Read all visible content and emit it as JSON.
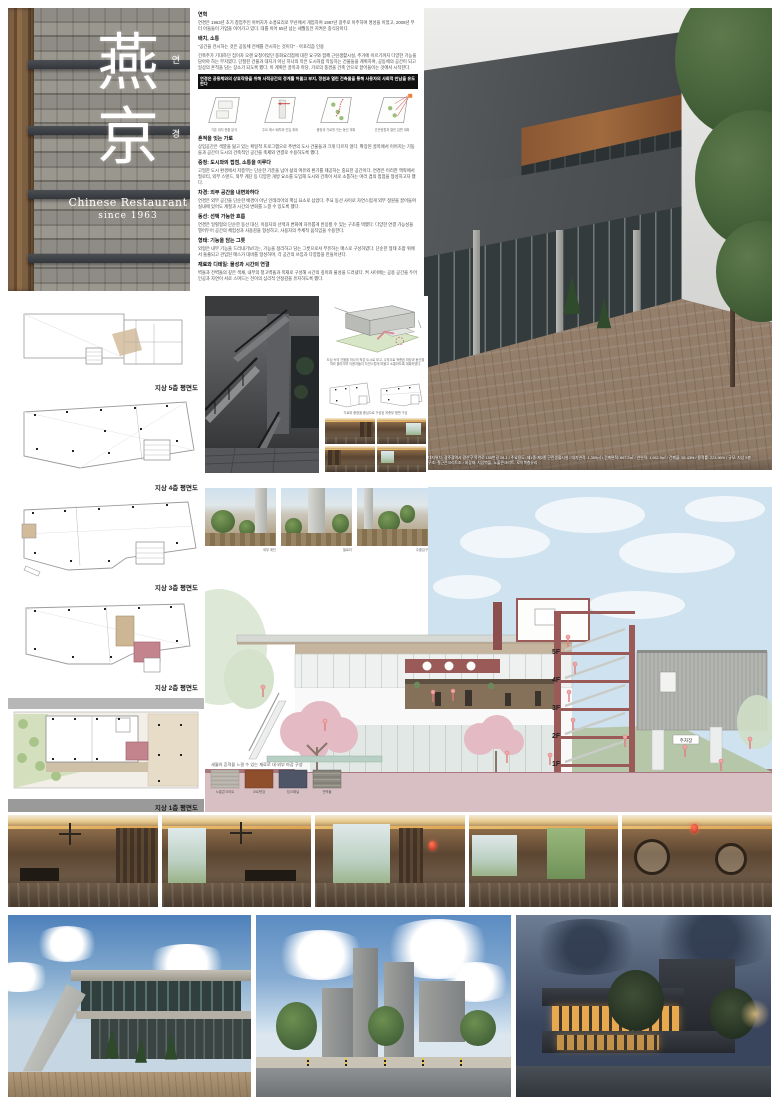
{
  "board": {
    "sign": {
      "hanja_top": "燕",
      "hangul_top": "연",
      "hanja_bottom": "京",
      "hangul_bottom": "경",
      "subtitle": "Chinese Restaurant",
      "since": "since 1963"
    },
    "intro": {
      "s1_heading": "연혁",
      "s1_body": "연경은 1963년 초기 창업주인 아버지가 소흥요리로 부산에서 개업하여 1987년 광주로 이주하며 명성을 이었고, 2008년 부터 아들들이 가업을 이어가고 있다. 대를 이어 55년 넘는 세월동안 지켜온 중식당이다.",
      "s2_heading": "배치, 소통",
      "s2_body": "\"공간을 전시하는 것은 공동체 전체를 전시하는 것이다\" - 아포리즘 인용",
      "s3_body": "건축주가 기대하던 집이자 오랜 요청이었던 중화요리점에 대한 요구와 함께 근린생활시설, 주거에 이르기까지 다양한 기능을 담아야 하는 부지였다. 단절된 건물과 대지가 아닌 하나의 작은 도시처럼 작동하는 건물들을 계획하여, 공동체의 공간이 되고 일상의 흔적을 담는 장소가 되도록 했다. 이 계획은 골목과 마당, 가로의 풍경을 건축 안으로 끌어들이는 것에서 시작한다.",
      "highlight": "연경은 공동체와의 상호작용을 위해 사적공간의 경계를 허물고 부지, 정원과 열린 건축물을 통해 사용자의 사회적 만남을 유도한다",
      "diagram_captions": [
        "기존 대지 현황 분석",
        "주요 매스 배치와 진입 계획",
        "중정과 가로를 잇는 동선 계획",
        "선큰정원과 열린 입면 계획"
      ],
      "s4_heading": "흔적을 잇는 가로",
      "s4_body": "상업공간은 색깔을 잃고 있는 획일적 프로그램으로 주변의 도시 건물들과 크게 다르지 않다. 확장된 골목에서 이어지는 기둥들과 공간이 도시의 건축적인 공간을 축제와 연결로 수용하도록 했다.",
      "s5_heading": "중정: 도시와의 접점, 소통을 이루다",
      "s5_body": "고밀한 도시 환경에서 저층부는 단순한 기준을 넘어 삶의 여유와 환기를 제공하는 중요한 공간이다. 연경은 이러한 맥락에서 필로티, 외부 스탠드, 외부 계단 등 다양한 개방 요소를 도입해 도시와 건축이 서로 소통하는 여러 겹의 접점을 형성하고자 했다.",
      "s6_heading": "차경: 외부 공간을 내면화하다",
      "s6_body": "연경은 외부 공간을 단순한 배경이 아닌 인테리어의 핵심 요소로 삼았다. 주요 동선 사이로 자연스럽게 외부 정원을 끌어들여 실내에 있어도 계절과 시간의 변화를 느낄 수 있도록 했다.",
      "s7_heading": "동선: 선택 가능한 흐름",
      "s7_body": "연경은 일렬형의 단순한 동선 대신, 이용자의 선택과 변화에 자유롭게 반응할 수 있는 구조를 택했다. 다양한 연결 가능성을 열어두어 공간의 체험성과 사용감을 형성하고, 사용자의 주체적 움직임을 수용한다.",
      "s8_heading": "형태: 기능을 담는 그릇",
      "s8_body": "외형은 내부 기능을 드러내기보다는, 기능을 정리하고 담는 그릇으로서 부유하는 매스로 구성하였다. 단순한 형태 조합 위에서 돌출되고 관입된 매스가 대비를 형성하며, 각 공간의 쓰임과 다양함을 만들어낸다.",
      "s9_heading": "재료와 디테일: 물성과 시간의 연결",
      "s9_body": "벽돌과 전벽돌의 깊은 색채, 내부의 청고벽돌과 목재로 구성해 시간의 깊이와 물성을 드러냈다. 켜 사이에는 공용 공간을 두어 인공과 자연이 서로 스며드는 전이의 심리적 안정감을 유지하도록 했다."
    },
    "main_photo": {
      "caption1": "대지위치: 광주광역시 광산구 목련로 155번길 28-1 / 주요용도: 제1종·제2종 근린생활시설 / 대지면적: 1,355㎡ / 건축면적: 667.5㎡ / 연면적: 1,962.9㎡ / 건폐율: 55.43% / 용적률: 223.96% / 규모: 지상 5층",
      "caption2": "구조: 철근콘크리트조 / 외장재: 치장벽돌, 노출콘크리트, 로이복층유리"
    },
    "plans": {
      "labels": [
        "지상 5층 평면도",
        "지상 4층 평면도",
        "지상 3층 평면도",
        "지상 2층 평면도",
        "지상 1층 평면도"
      ]
    },
    "panel": {
      "axon_caption": "도심 속의 건물을 하나의 작은 도시로 보고, 수직으로 적층된 마당과 동선을 따라 올라가며 이용자들이 자연스럽게 머물고 소통하도록 계획하였다.",
      "plans_caption": "가로와 중정을 중심으로 구성된 저층부 평면 구성"
    },
    "courtyard": {
      "captions": [
        "외부 계단",
        "필로티",
        "주출입구"
      ]
    },
    "section": {
      "floor_labels": [
        "5F",
        "4F",
        "3F",
        "2F",
        "1F"
      ],
      "parking_label": "주차장",
      "materials_caption": "세월의 흔적을 느낄 수 있는 재료로 내·외부 마감 구성",
      "materials": [
        "노출콘크리트",
        "코르텐강",
        "징크패널",
        "전벽돌"
      ]
    },
    "colors": {
      "accent_maroon": "#9a5a58",
      "ground_pink": "#d8bfc3",
      "sky_blue": "#cfe2ef",
      "hill_green": "#b6c6a9",
      "highlight_bar": "#111111"
    }
  }
}
